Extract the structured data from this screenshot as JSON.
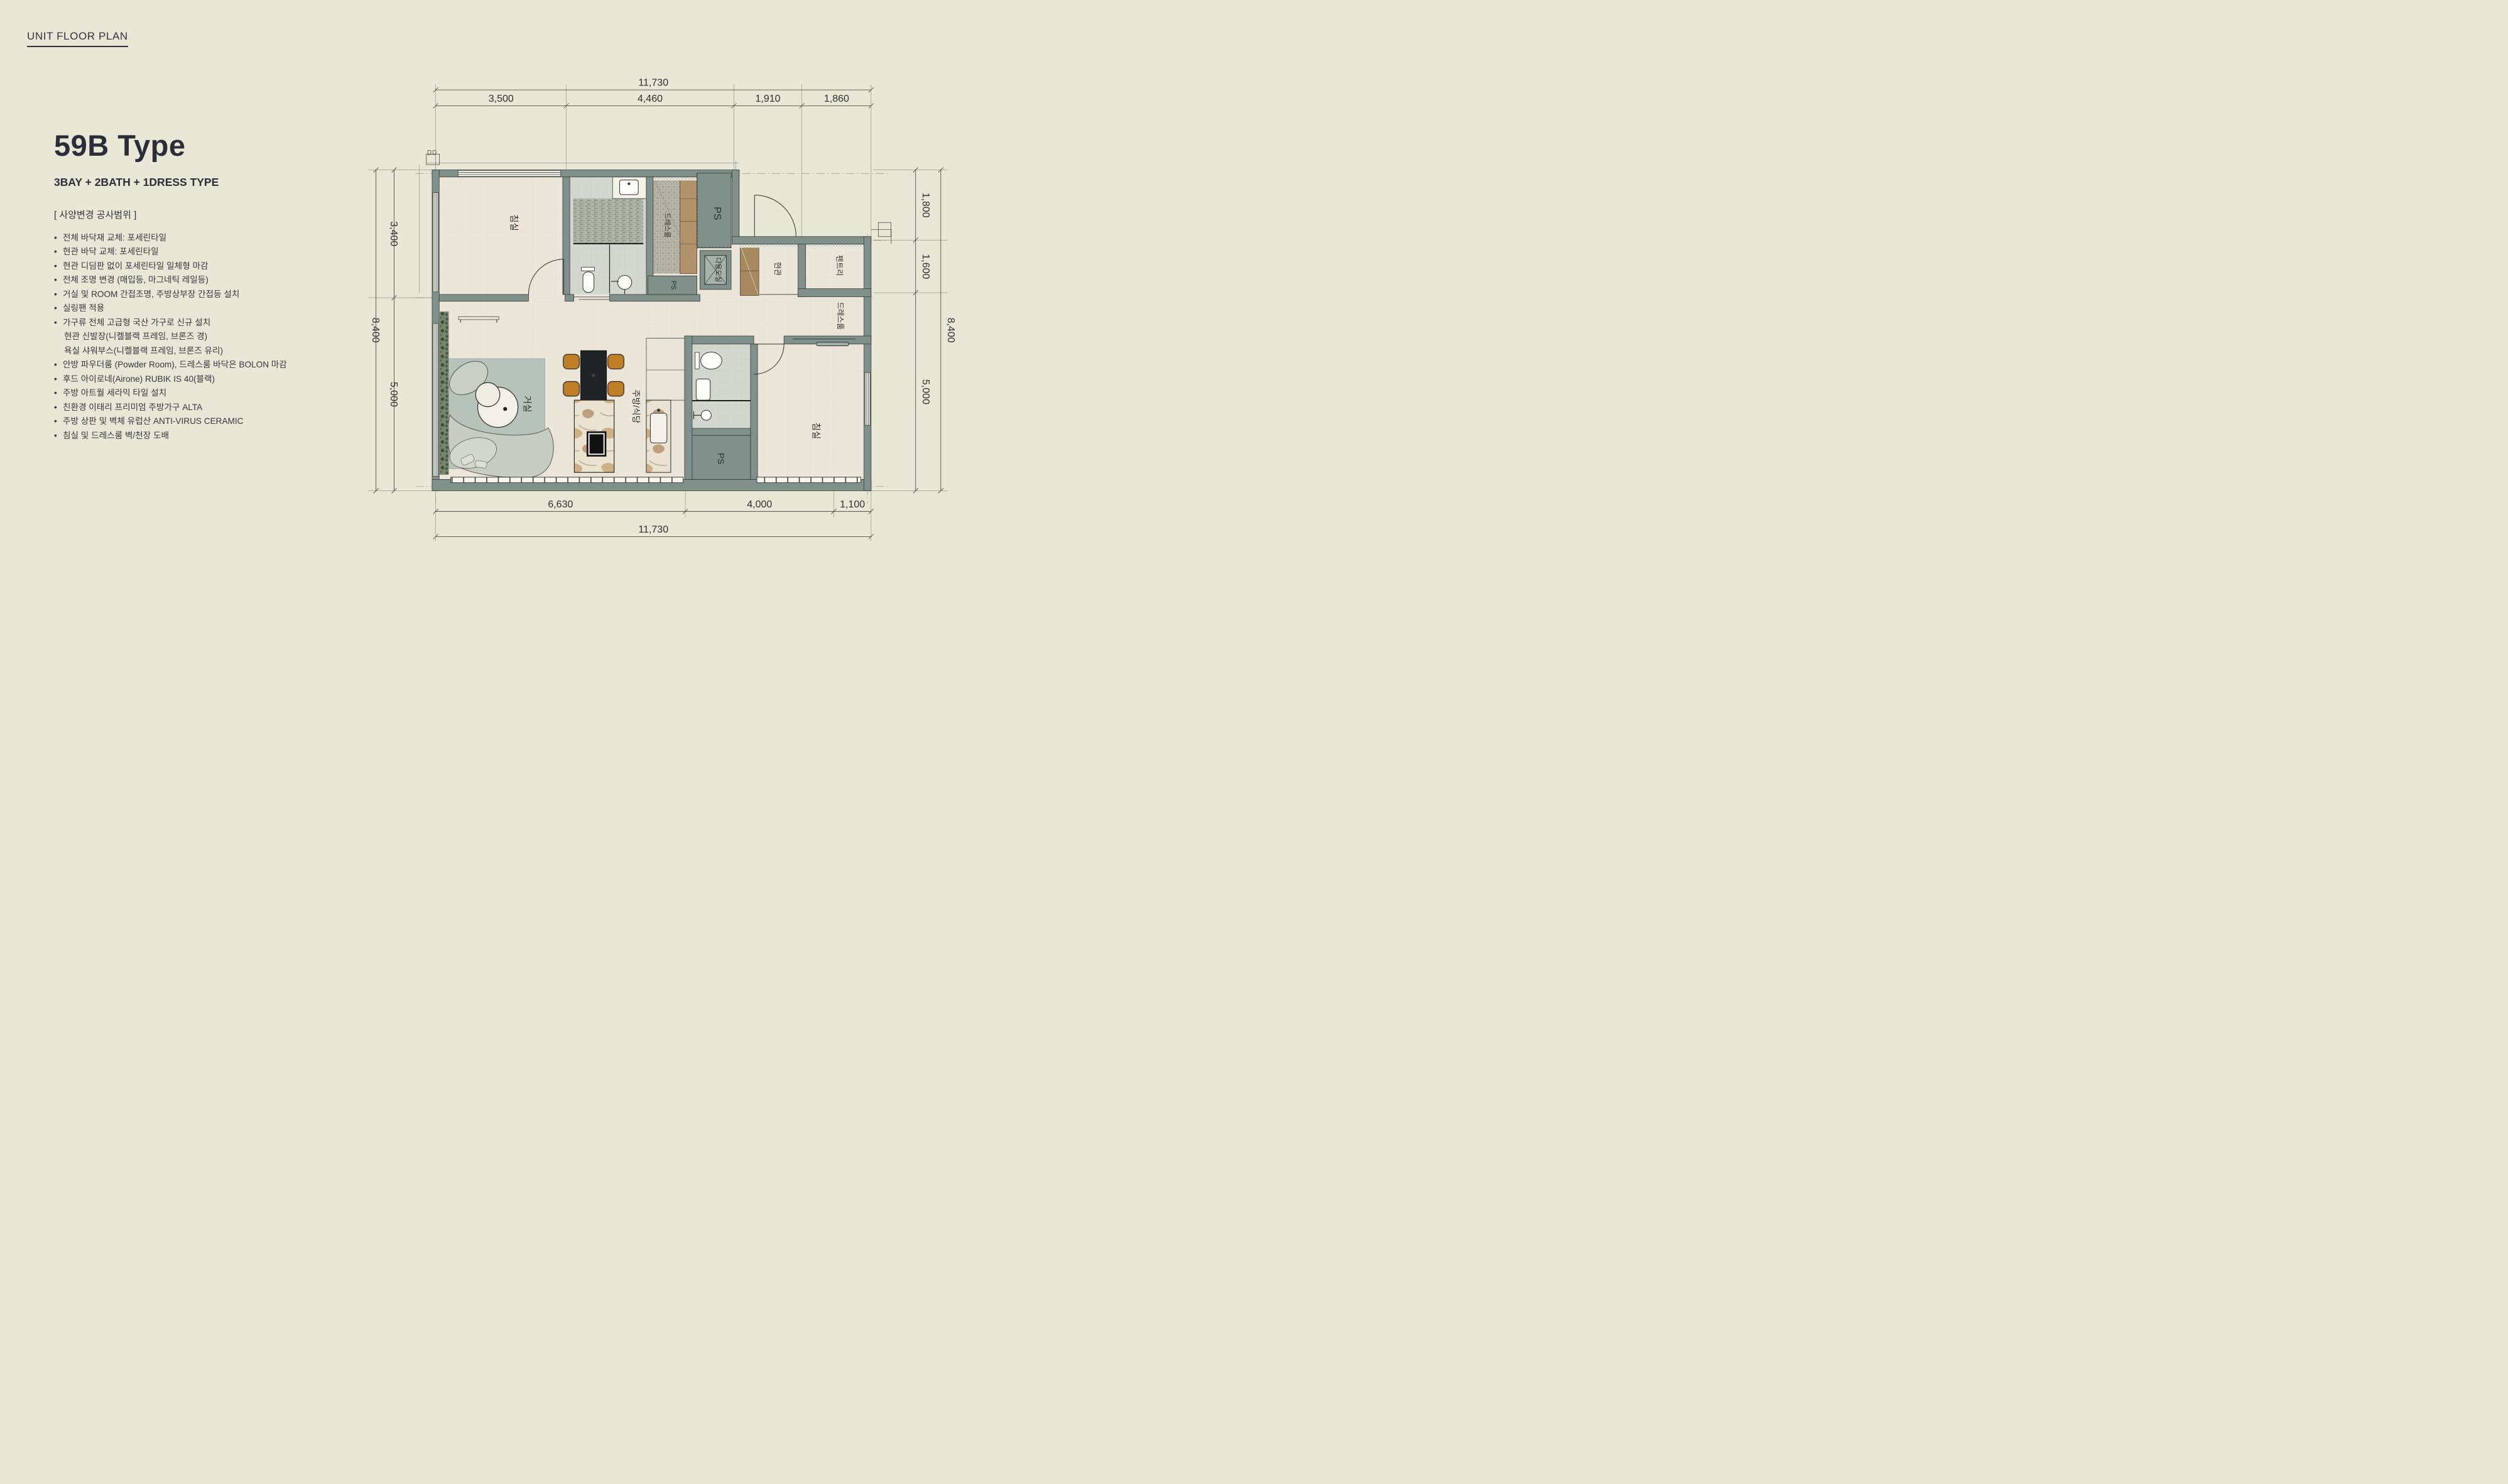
{
  "page": {
    "title": "UNIT FLOOR PLAN"
  },
  "unit": {
    "name": "59B Type",
    "subtitle": "3BAY + 2BATH + 1DRESS TYPE",
    "section_header": "[ 사양변경 공사범위 ]",
    "bullet_char": "•",
    "specs": [
      {
        "indent": false,
        "text": "전체 바닥재 교체: 포세린타일"
      },
      {
        "indent": false,
        "text": "현관 바닥 교체: 포세린타일"
      },
      {
        "indent": false,
        "text": "현관 디딤판 없이 포세린타일 일체형 마감"
      },
      {
        "indent": false,
        "text": "전체 조명 변경 (매입등, 마그네틱 레일등)"
      },
      {
        "indent": false,
        "text": "거실 및 ROOM 간접조명, 주방상부장 간접등 설치"
      },
      {
        "indent": false,
        "text": "실링팬 적용"
      },
      {
        "indent": false,
        "text": "가구류 전체 고급형 국산 가구로 신규 설치"
      },
      {
        "indent": true,
        "text": "현관 신발장(니켈블랙 프레임, 브론즈 경)"
      },
      {
        "indent": true,
        "text": "욕실 샤워부스(니켈블랙 프레임, 브론즈 유리)"
      },
      {
        "indent": false,
        "text": "안방 파우더룸 (Powder Room), 드레스룸 바닥은 BOLON 마감"
      },
      {
        "indent": false,
        "text": "후드 아이로네(Airone) RUBIK IS 40(블랙)"
      },
      {
        "indent": false,
        "text": "주방 아트월 세라믹 타일 설치"
      },
      {
        "indent": false,
        "text": "친환경 이태리 프리미엄 주방가구 ALTA"
      },
      {
        "indent": false,
        "text": "주방 상판 및 벽체 유럽산 ANTI-VIRUS CERAMIC"
      },
      {
        "indent": false,
        "text": "침실 및 드레스룸 벽/천장 도배"
      }
    ]
  },
  "plan": {
    "colors": {
      "wall": "#80918b",
      "floor": "#ece6da",
      "accent_chair": "#bf7e28",
      "rug": "#b7c2ba"
    },
    "rooms": {
      "bedroom1": "침실",
      "dress1": "드레스룸",
      "ps_top": "PS",
      "utility": "다용도실",
      "ps_mid": "PS",
      "entrance": "현관",
      "pantry": "펜트리",
      "dress2": "드레스룸",
      "living": "거실",
      "kitchen": "주방/식당",
      "bedroom2": "침실",
      "ps_bottom": "PS"
    },
    "dims": {
      "top_total": "11,730",
      "top_segments": [
        "3,500",
        "4,460",
        "1,910",
        "1,860"
      ],
      "left_total": "8,400",
      "left_segments": [
        "3,400",
        "5,000"
      ],
      "right_total": "8,400",
      "right_segments": [
        "1,800",
        "1,600",
        "5,000"
      ],
      "bottom_total": "11,730",
      "bottom_segments": [
        "6,630",
        "4,000",
        "1,100"
      ]
    }
  }
}
